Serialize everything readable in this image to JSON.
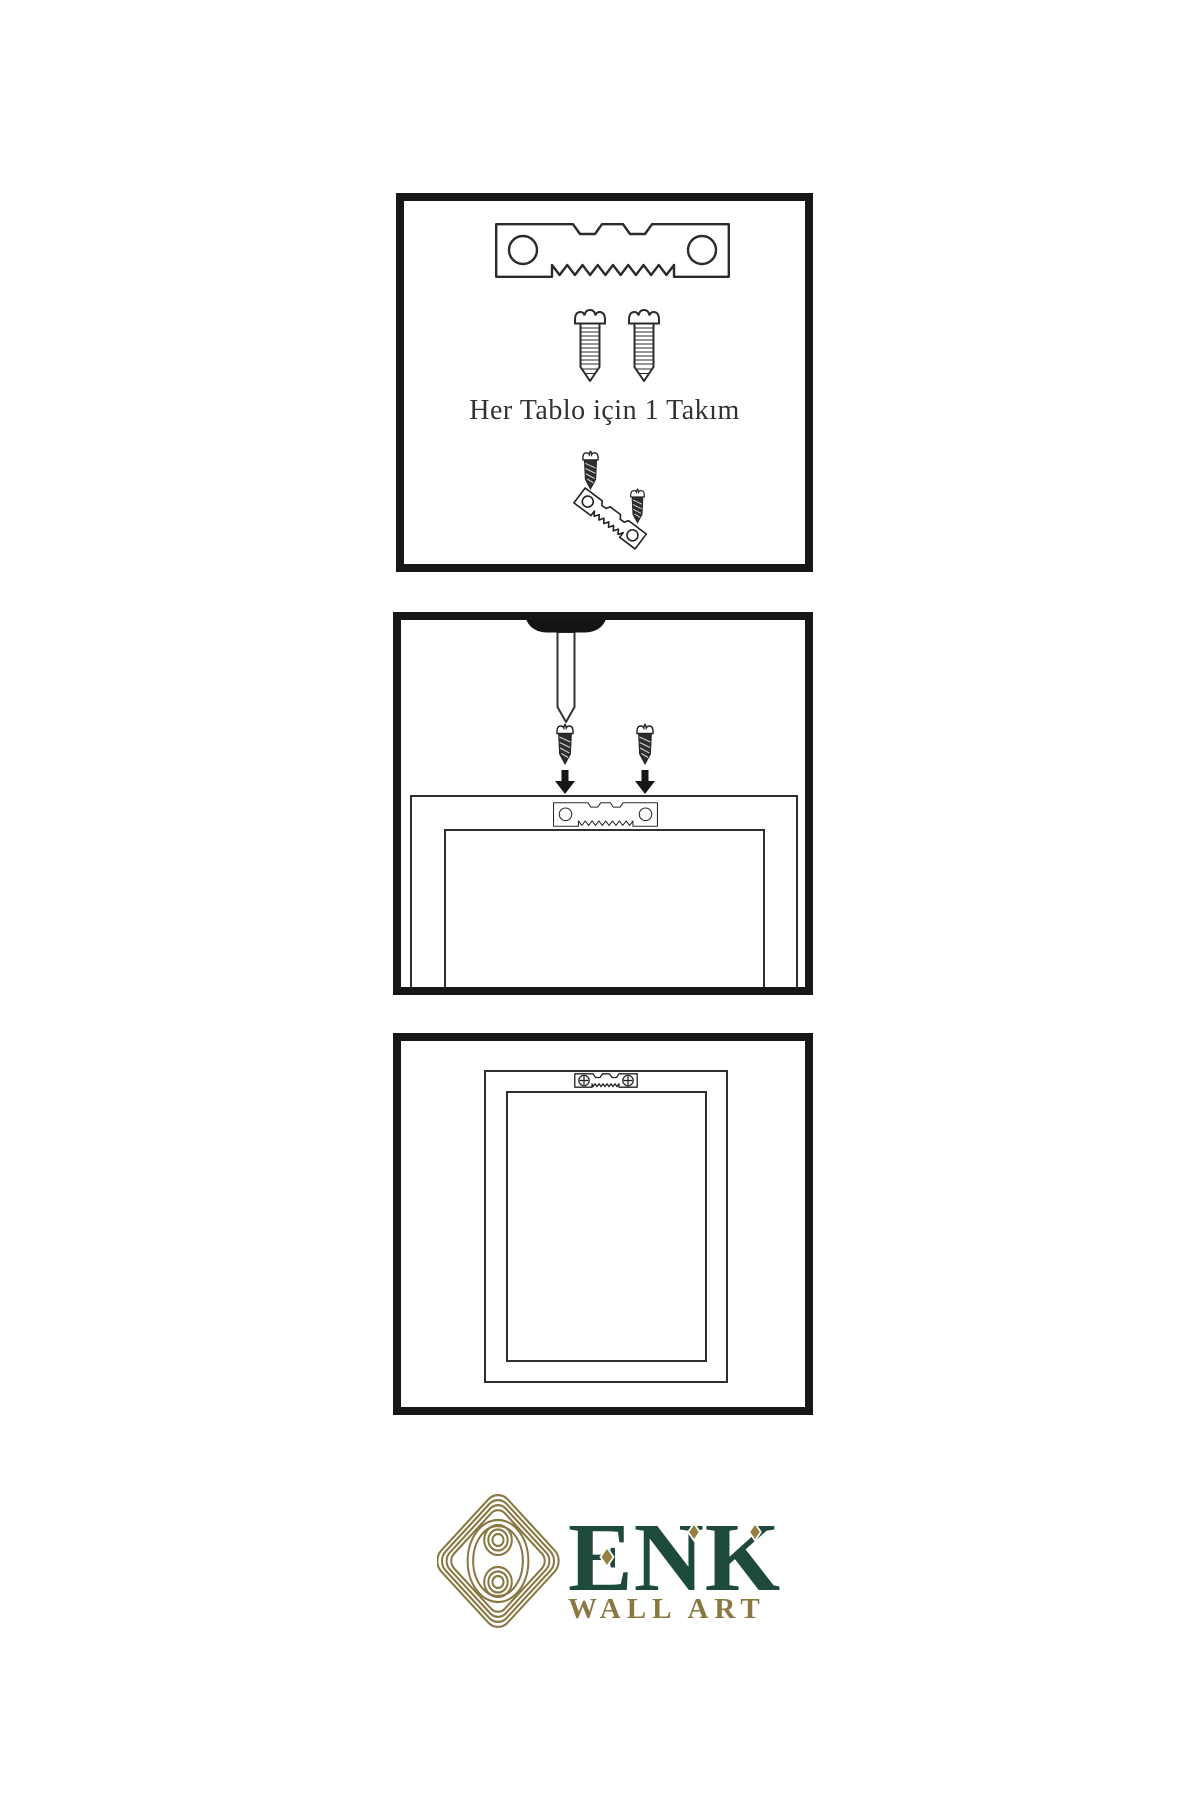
{
  "page": {
    "background": "#ffffff",
    "width": 1200,
    "height": 1800
  },
  "colors": {
    "panel_border": "#171717",
    "illustration_line": "#2b2b2b",
    "screw_dark": "#2e2e2e",
    "brand_green": "#1d4a3d",
    "brand_gold": "#8a7843",
    "accent_gold": "#97803f",
    "caption_text": "#333333"
  },
  "panels": {
    "kit": {
      "caption": "Her Tablo için 1 Takım",
      "icons": [
        "sawtooth-hanger-icon",
        "screw-icon",
        "screw-icon",
        "hanger-mounting-icon"
      ]
    },
    "mounting": {
      "icons": [
        "wall-nail-icon",
        "dark-screw-icon",
        "dark-screw-icon",
        "arrow-down-icon",
        "arrow-down-icon",
        "sawtooth-hanger-icon",
        "frame-back-icon"
      ]
    },
    "hung": {
      "icons": [
        "framed-picture-icon",
        "mini-sawtooth-hanger-icon"
      ]
    }
  },
  "logo": {
    "brand": "ENK",
    "subtitle": "WALL ART",
    "icon": "knot-emblem-icon"
  }
}
